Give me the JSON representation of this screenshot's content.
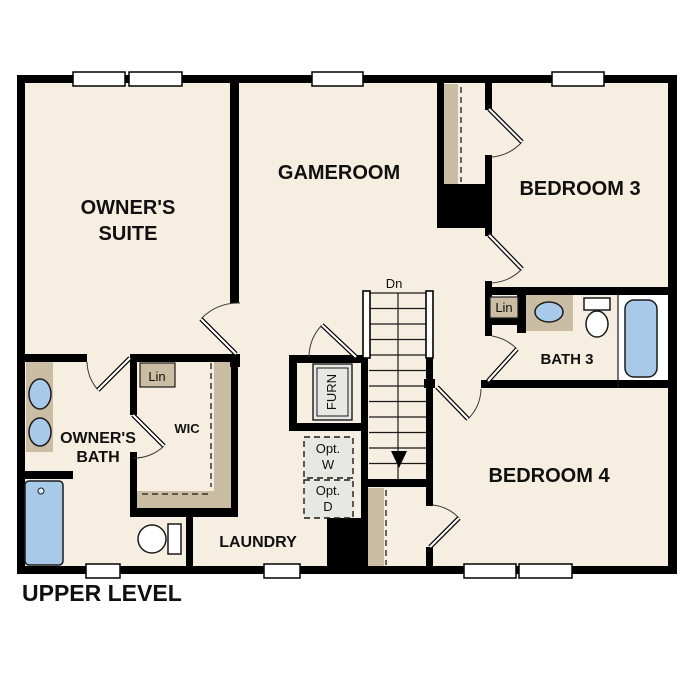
{
  "plan": {
    "title": "UPPER LEVEL",
    "rooms": {
      "owners_suite": {
        "line1": "OWNER'S",
        "line2": "SUITE"
      },
      "gameroom": {
        "label": "GAMEROOM"
      },
      "bedroom3": {
        "label": "BEDROOM 3"
      },
      "bath3": {
        "label": "BATH 3"
      },
      "bedroom4": {
        "label": "BEDROOM 4"
      },
      "owners_bath": {
        "line1": "OWNER'S",
        "line2": "BATH"
      },
      "wic": {
        "label": "WIC"
      },
      "laundry": {
        "label": "LAUNDRY"
      }
    },
    "closets": {
      "lin_wic": "Lin",
      "lin_bath3": "Lin"
    },
    "stairs": {
      "direction_label": "Dn"
    },
    "equipment": {
      "furnace": "FURN",
      "opt_washer": {
        "line1": "Opt.",
        "line2": "W"
      },
      "opt_dryer": {
        "line1": "Opt.",
        "line2": "D"
      }
    },
    "colors": {
      "background": "#ffffff",
      "floor": "#f6eee1",
      "wall": "#000000",
      "counter_tan": "#cbbda3",
      "fixture_blue": "#a9c9e9",
      "equipment_gray": "#e7e7e3"
    }
  }
}
